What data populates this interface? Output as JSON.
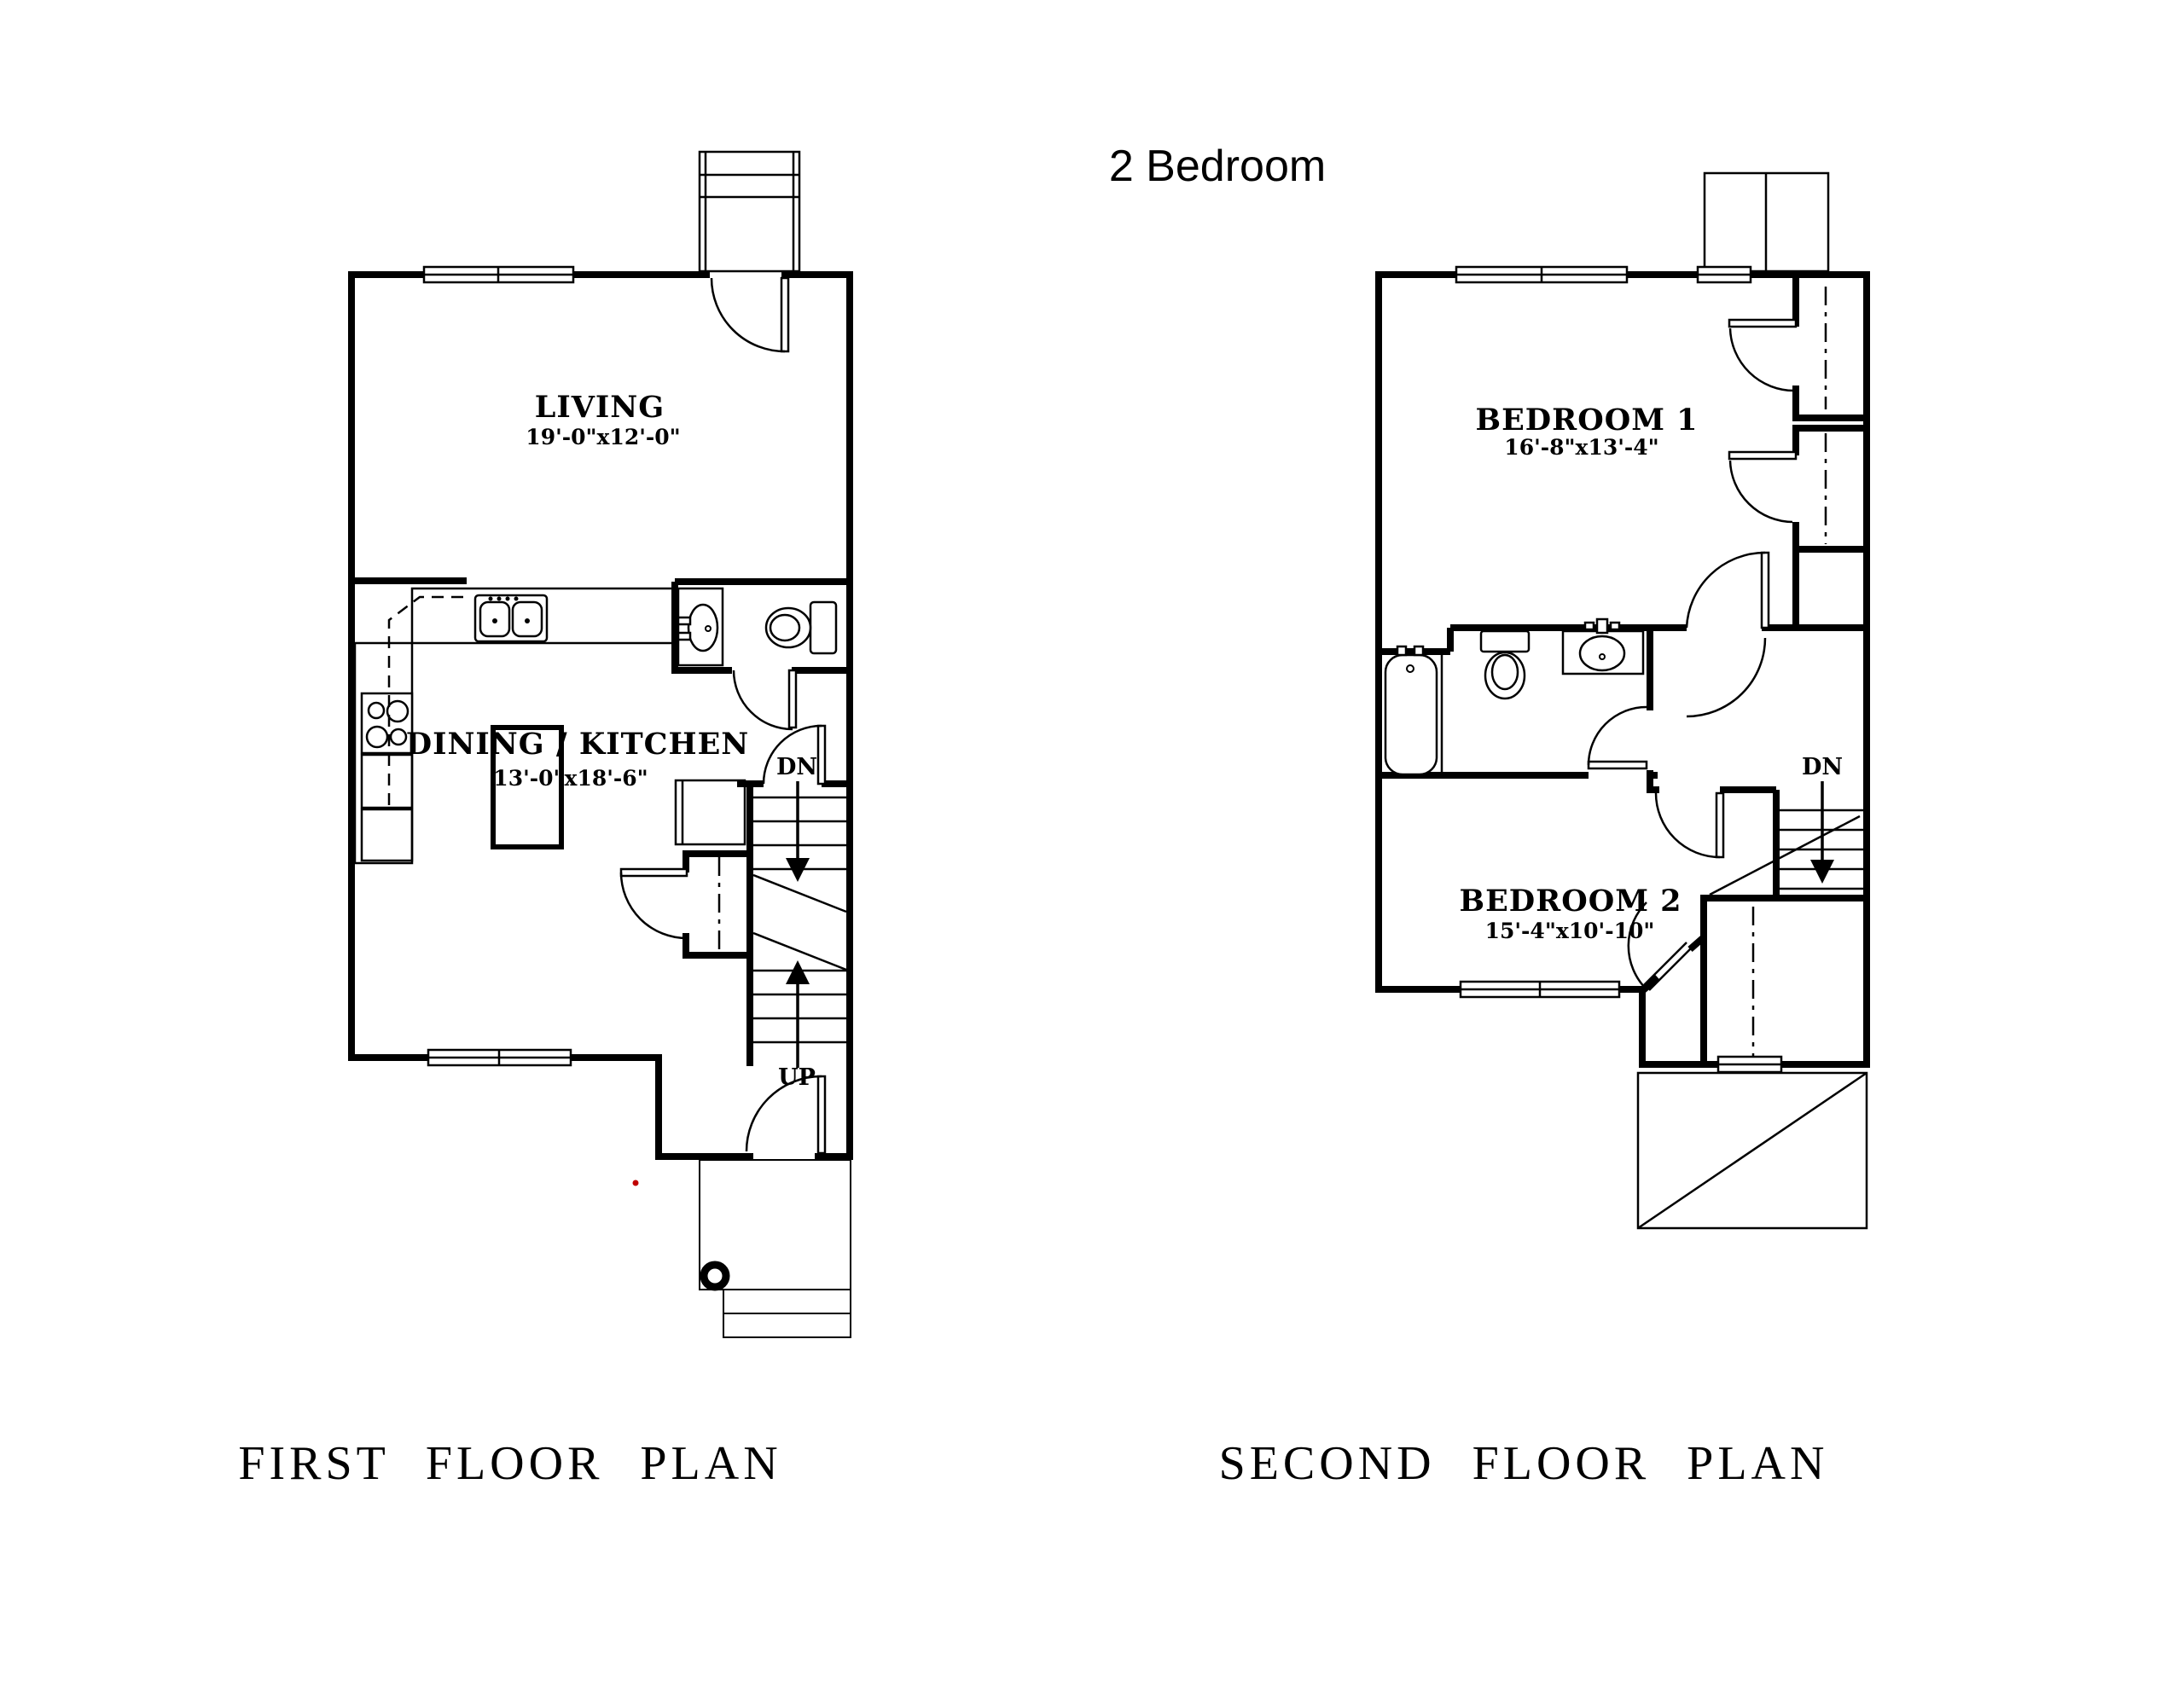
{
  "title": "2 Bedroom",
  "colors": {
    "background": "#ffffff",
    "line": "#000000",
    "accent_dot": "#c00000"
  },
  "first_floor": {
    "title": "FIRST FLOOR PLAN",
    "rooms": {
      "living": {
        "name": "LIVING",
        "dims": "19'-0\"x12'-0\""
      },
      "dining_kitchen": {
        "name": "DINING / KITCHEN",
        "dims": "13'-0\"x18'-6\""
      }
    },
    "stairs": {
      "dn": "DN",
      "up": "UP"
    }
  },
  "second_floor": {
    "title": "SECOND FLOOR PLAN",
    "rooms": {
      "bedroom1": {
        "name": "BEDROOM 1",
        "dims": "16'-8\"x13'-4\""
      },
      "bedroom2": {
        "name": "BEDROOM 2",
        "dims": "15'-4\"x10'-10\""
      }
    },
    "stairs": {
      "dn": "DN"
    }
  }
}
